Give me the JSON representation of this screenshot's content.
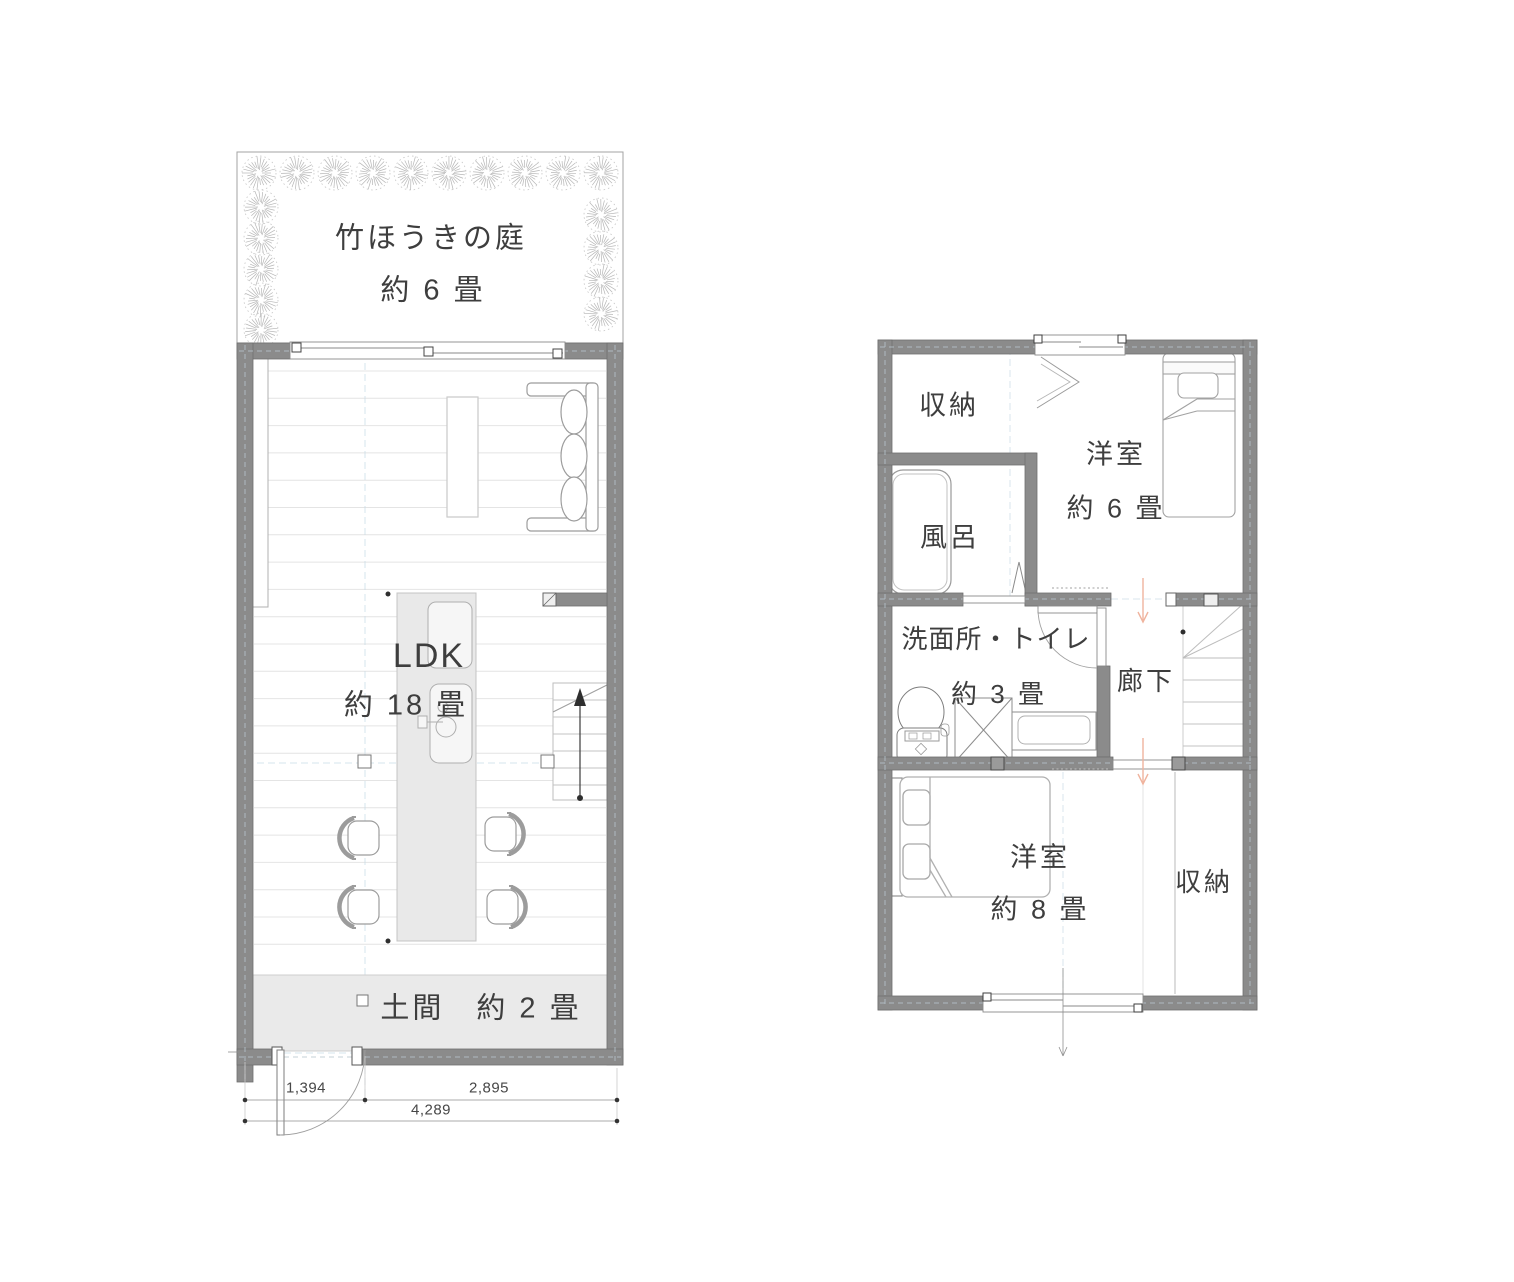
{
  "floor1": {
    "garden_name": "竹ほうきの庭",
    "garden_size": "約 6 畳",
    "ldk_label": "LDK",
    "ldk_size": "約 18 畳",
    "doma_label": "土間　約 2 畳",
    "dimensions": {
      "left": "1,394",
      "right": "2,895",
      "total": "4,289"
    }
  },
  "floor2": {
    "storage_top": "収納",
    "bath": "風呂",
    "bedroom_small": {
      "name": "洋室",
      "size": "約 6 畳"
    },
    "washroom": {
      "name": "洗面所・トイレ",
      "size": "約 3 畳"
    },
    "hallway": "廊下",
    "bedroom_large": {
      "name": "洋室",
      "size": "約 8 畳"
    },
    "storage_bottom": "収納"
  },
  "colors": {
    "wall": "#8b8b8b",
    "floor_fill": "#eaeaea",
    "furniture_stroke": "#9c9c9c",
    "grid_dash": "#c9dbe6",
    "arrow_accent": "#f0b49e",
    "text": "#3e3e3e"
  }
}
